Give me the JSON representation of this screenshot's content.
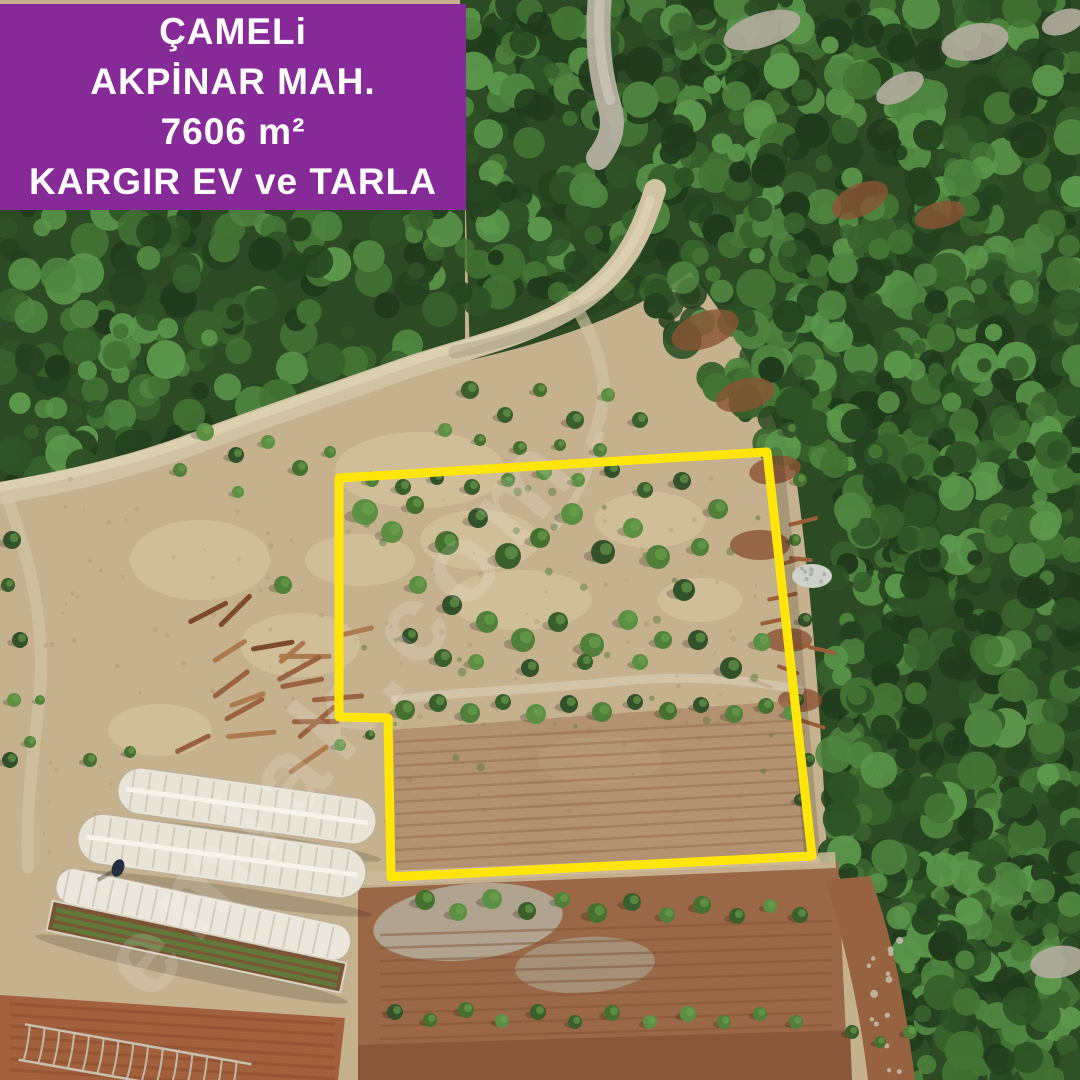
{
  "banner": {
    "lines": [
      "ÇAMELi",
      "AKPİNAR MAH.",
      "7606 m²",
      "KARGIR EV ve TARLA"
    ],
    "bg_color": "#862a97",
    "text_color": "#ffffff"
  },
  "watermark": {
    "text": "emlak.com",
    "color": "#ffffff",
    "opacity": "0.14"
  },
  "boundary": {
    "color": "#ffe608",
    "stroke_width": "9",
    "points": "339,478 767,452 812,856 391,877 388,718 339,717"
  },
  "scene": {
    "soil_color": "#c6b18e",
    "forest_color": "#2c4a24",
    "field_brown": "#9b6847",
    "field_orange": "#a2603c",
    "road_color": "#cfc3a3",
    "greenhouse_color": "#e9e4d8"
  }
}
